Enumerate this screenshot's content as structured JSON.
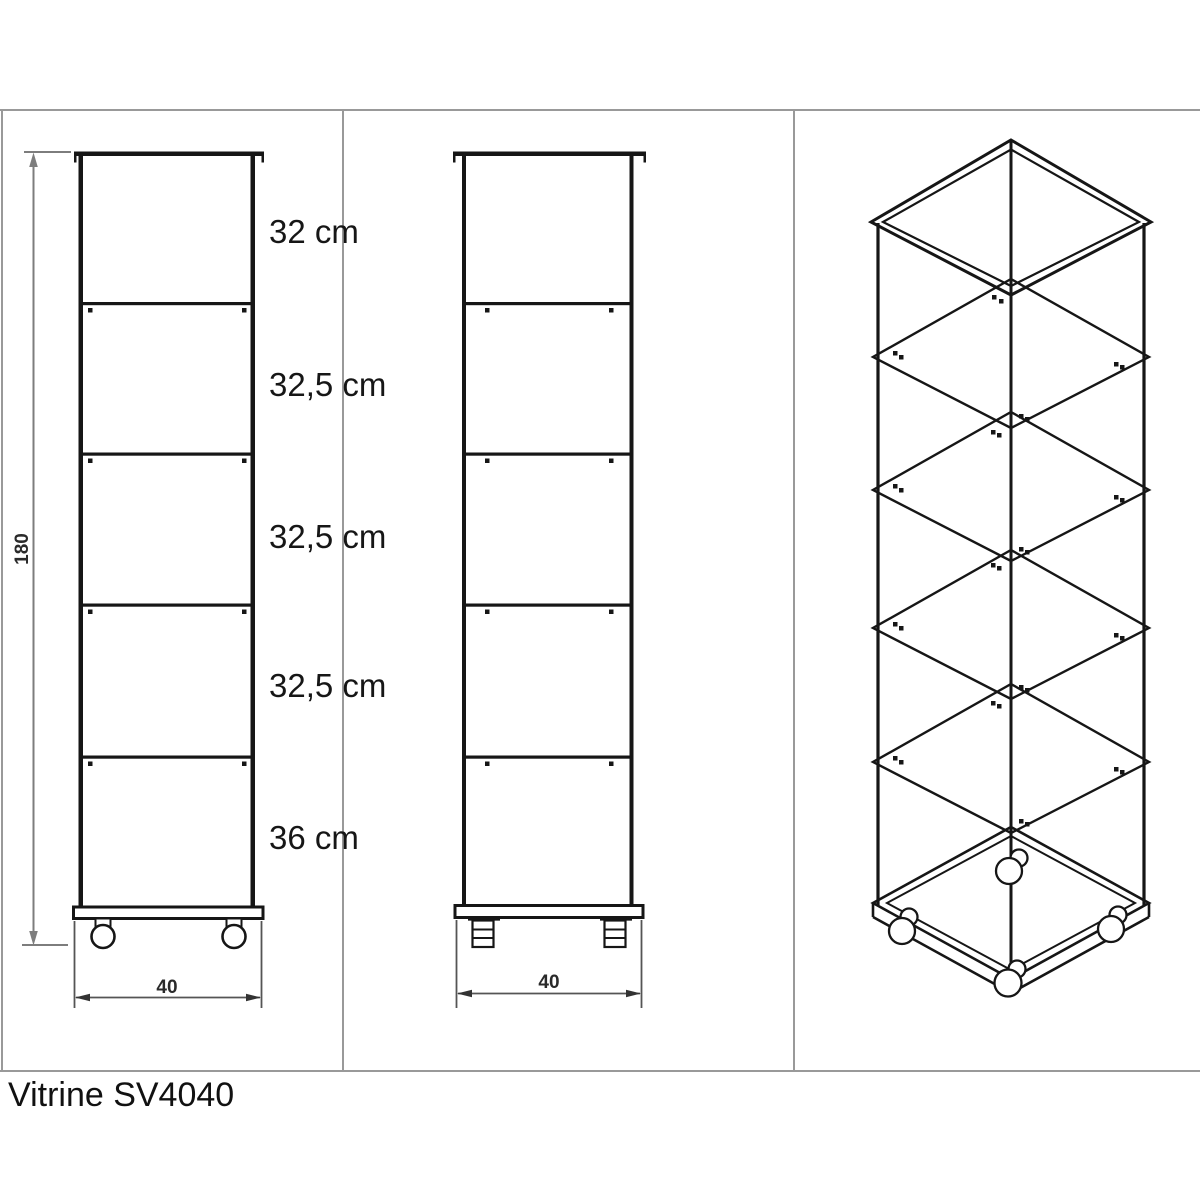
{
  "drawing": {
    "title": "Vitrine SV4040",
    "type_note": "technical three-view furniture drawing"
  },
  "front_view": {
    "shelf_spacing_labels": [
      "32 cm",
      "32,5 cm",
      "32,5 cm",
      "32,5 cm",
      "36 cm"
    ],
    "height_label": "180",
    "width_label": "40"
  },
  "side_view": {
    "width_label": "40"
  },
  "iso_view": {
    "description": "isometric view of glass vitrine with four shelves and casters"
  },
  "colors": {
    "line": "#161616",
    "dimension": "#555555",
    "dimension_height": "#7d7d7d",
    "frame_border": "#999999"
  }
}
